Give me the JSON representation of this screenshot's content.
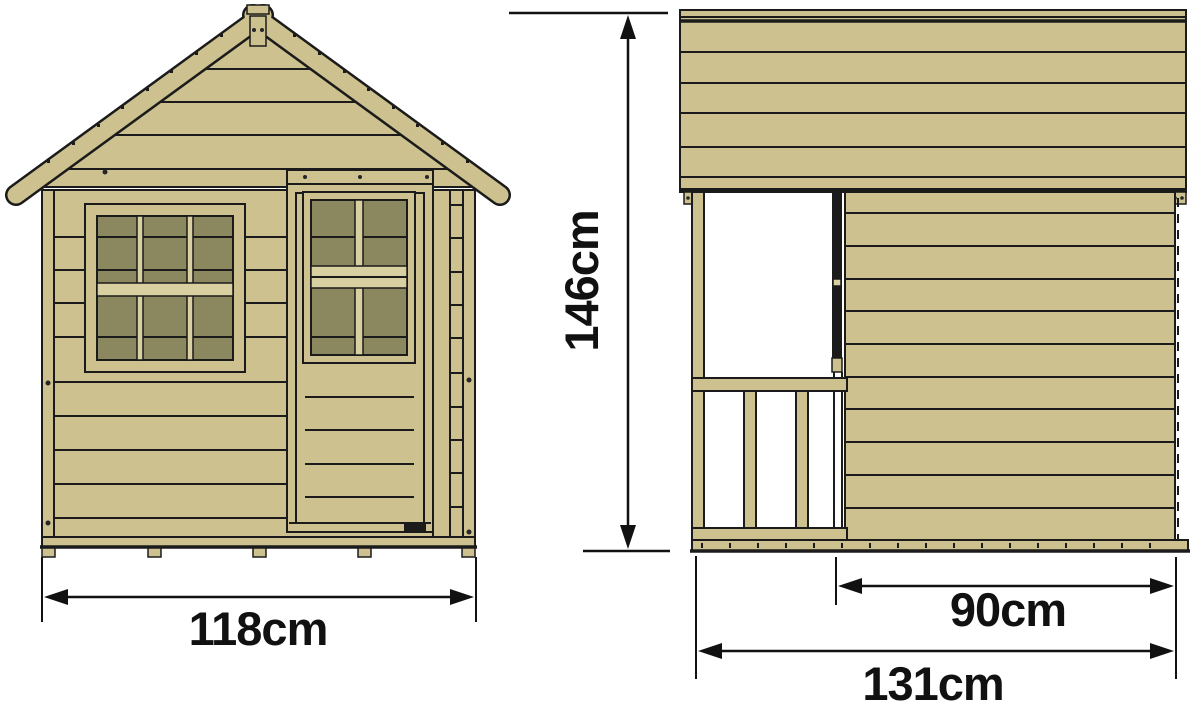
{
  "page": {
    "title": "Wooden playhouse dimension drawing",
    "background": "#ffffff"
  },
  "colors": {
    "wood": "#cdc28f",
    "wood_light": "#d9d0a2",
    "glass": "#8b875f",
    "ink": "#1b1b1b",
    "dim": "#111111"
  },
  "views": {
    "front": {
      "name": "front-elevation",
      "dimension_width": {
        "label": "118cm"
      }
    },
    "side": {
      "name": "side-elevation",
      "dimension_height": {
        "label": "146cm"
      },
      "dimension_body_depth": {
        "label": "90cm"
      },
      "dimension_total_depth": {
        "label": "131cm"
      }
    }
  }
}
